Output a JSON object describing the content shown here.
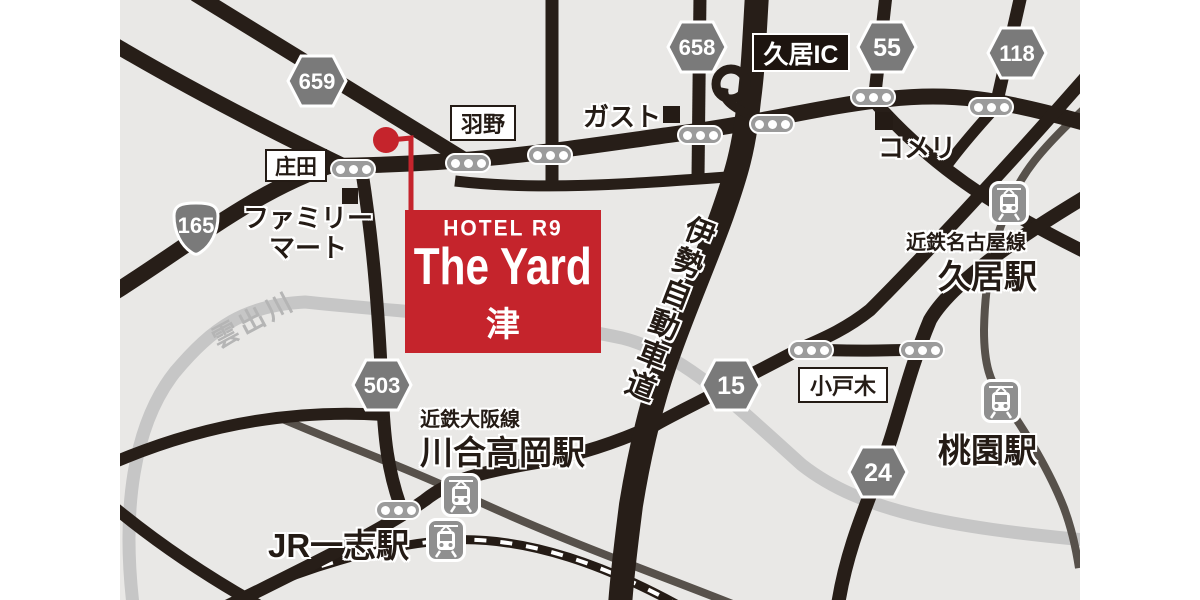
{
  "hotel": {
    "brand": "HOTEL R9",
    "name": "The Yard",
    "city": "津"
  },
  "badges": {
    "b659": "659",
    "b658": "658",
    "b55": "55",
    "b118": "118",
    "b15": "15",
    "b24": "24",
    "b503": "503",
    "b165": "165"
  },
  "interchange": {
    "hisai_ic": "久居IC"
  },
  "intersections": {
    "shoda": "庄田",
    "hano": "羽野",
    "obeki": "小戸木"
  },
  "pois": {
    "gusto": "ガスト",
    "komeri": "コメリ",
    "familymart": "ファミリーマート"
  },
  "stations": {
    "hisai": {
      "line": "近鉄名古屋線",
      "name": "久居駅"
    },
    "momozono": {
      "name": "桃園駅"
    },
    "kawai_takaoka": {
      "line": "近鉄大阪線",
      "name": "川合高岡駅"
    },
    "jr_ichishi": {
      "name": "JR一志駅"
    }
  },
  "roads": {
    "expressway": "伊勢自動車道",
    "river": "雲出川"
  },
  "colors": {
    "accent_red": "#c5242c",
    "road_black": "#271e18",
    "rail_gray": "#57514b",
    "river_gray": "#c6c6c6",
    "badge_gray": "#7a7a7a",
    "map_bg": "#e9e8e6"
  }
}
